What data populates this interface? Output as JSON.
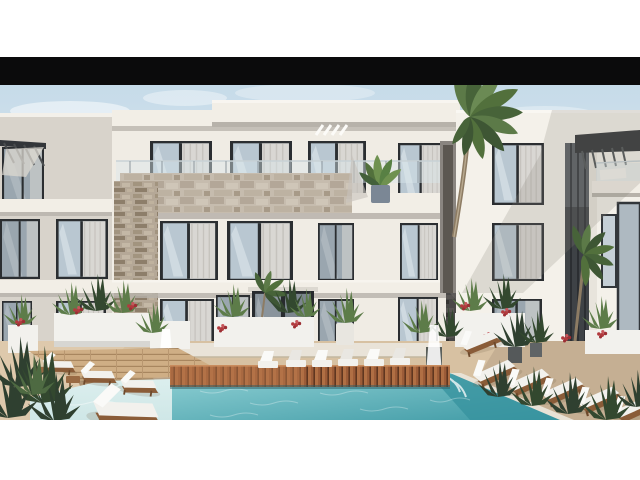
{
  "meta": {
    "type": "architectural-rendering",
    "subject": "modern three-storey residential apartment complex with courtyard swimming pool",
    "style": "letterboxed photo on white page, black bar above rendering",
    "text_visible": "none"
  },
  "colors": {
    "bar": "#0b0b0c",
    "page_bg": "#ffffff",
    "sky_top": "#c6dbe9",
    "sky_horizon": "#eef1f2",
    "facade_lit": "#f0ece4",
    "facade_bright": "#f4f1ea",
    "facade_shade": "#d8d3cb",
    "roof_white": "#f2eee6",
    "under_shadow": "#b7b2aa",
    "window_frame": "#2b2e31",
    "glass_light": "#b9c7d1",
    "glass_dark": "#9aa6af",
    "curtain": "#dbd8d3",
    "stone_tan": "#b5a897",
    "stone_parapet": "#c6bcae",
    "stone_dark": "#4a4847",
    "railing_glass": "#d9e6ea",
    "deck_sand": "#d7c1a2",
    "deck_shade": "#b7a186",
    "wood_red": "#9c5c38",
    "wood_light": "#cfae85",
    "pool_deep": "#3f9aa5",
    "pool_light": "#8fd0d4",
    "pool_pale": "#cfe7e7",
    "lounger_white": "#f2f1ed",
    "lounger_frame": "#8a5c38",
    "plant_green": "#5d7c49",
    "plant_dark": "#33482f",
    "bush_dark": "#2f4030",
    "flower_red": "#b23a3e",
    "palm_trunk": "#8d7c64",
    "fountain_white": "#ffffff"
  },
  "scene": {
    "elements": [
      "black letterbox bar across top of rendering",
      "pale blue sky with faint clouds",
      "left wing facade with dark slatted pergola and framed windows",
      "central block: flat white roof slab, four curtained windows per floor",
      "stone-clad balcony parapet and glass balustrade on first floor",
      "ground-floor glazed entrance door flanked by windows",
      "right wing: bright white facade, dark recessed glazing strip, rooftop pergola, small balcony",
      "dark grey stone accent wall near pool fountain",
      "large palm tree rising in front of the facade, second smaller palm at right",
      "green balcony plant on upper floor",
      "sand-coloured pool deck with white planters, red flowers and green shrubs",
      "two white fountain sprays",
      "turquoise swimming pool with wooden slatted edge and pale shallow arm at left",
      "white sun loungers: angled group at left, row behind pool, diagonal group at right",
      "dark foreground bushes in lower left and sculpted shrubs at right"
    ],
    "counts": {
      "loungers_left": 4,
      "loungers_center": 6,
      "loungers_right": 5,
      "palms": 2,
      "fountains": 2
    }
  }
}
